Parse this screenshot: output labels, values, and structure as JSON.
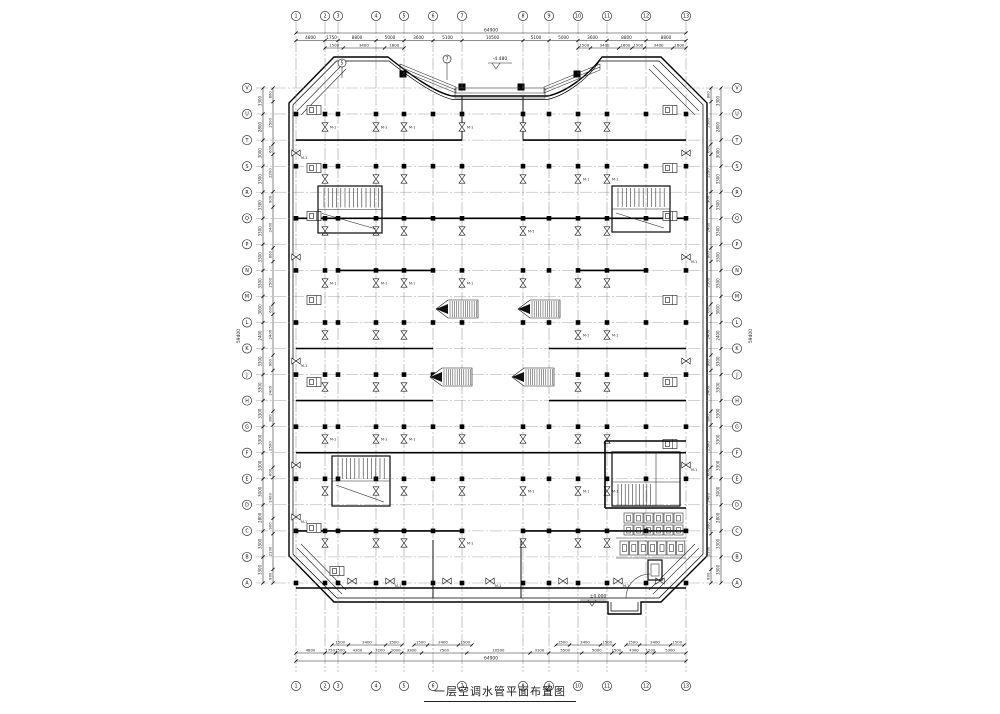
{
  "drawing": {
    "title": "一层空调水管平面布置图"
  },
  "axes": {
    "top": [
      "1",
      "2",
      "3",
      "4",
      "5",
      "6",
      "7",
      "8",
      "9",
      "10",
      "11",
      "12",
      "13"
    ],
    "bottom": [
      "1",
      "2",
      "3",
      "4",
      "5",
      "6",
      "7",
      "8",
      "9",
      "10",
      "11",
      "12",
      "13"
    ],
    "left": [
      "V",
      "U",
      "T",
      "S",
      "R",
      "Q",
      "P",
      "N",
      "M",
      "L",
      "K",
      "J",
      "H",
      "G",
      "F",
      "E",
      "D",
      "C",
      "B",
      "A"
    ],
    "right": [
      "V",
      "U",
      "T",
      "S",
      "R",
      "Q",
      "P",
      "N",
      "M",
      "L",
      "K",
      "J",
      "H",
      "G",
      "F",
      "E",
      "D",
      "C",
      "B",
      "A"
    ]
  },
  "dimensions": {
    "top_total": "64900",
    "top_major": [
      "4800",
      "1750",
      "8800",
      "5000",
      "3600",
      "5100",
      "10500",
      "5100",
      "5000",
      "3600",
      "8800",
      "8800"
    ],
    "top_sub_left": [
      "1500",
      "3400",
      "1600"
    ],
    "top_sub_right": [
      "1500",
      "3400",
      "1600",
      "1500",
      "3400",
      "1600"
    ],
    "bottom_total": "64900",
    "bottom_major": [
      "4800",
      "1750",
      "1500",
      "4300",
      "3200",
      "2000",
      "3300",
      "7500",
      "10500",
      "3100",
      "5500",
      "5000",
      "1500",
      "4300",
      "1200",
      "5300"
    ],
    "bottom_sub": [
      "1500",
      "3400",
      "1500"
    ],
    "left_total": "59400",
    "left_major": [
      "3300",
      "2800",
      "3000",
      "3300",
      "3300",
      "3300",
      "3300",
      "3300",
      "3000",
      "2400",
      "3300",
      "3300",
      "3300",
      "3300",
      "3300",
      "3000",
      "2800",
      "3300",
      "3300"
    ],
    "left_sub": [
      "800",
      "2500",
      "600",
      "2200",
      "900",
      "2400",
      "800",
      "2500",
      "600",
      "2400",
      "900",
      "2400",
      "800",
      "2500",
      "600",
      "2400",
      "900",
      "2100",
      "800"
    ],
    "right_total": "59400",
    "right_major": [
      "3300",
      "2800",
      "3000",
      "3300",
      "3300",
      "3300",
      "3300",
      "3300",
      "3000",
      "2400",
      "3300",
      "3300",
      "3300",
      "3300",
      "3300",
      "3000",
      "2800",
      "3300",
      "3300"
    ],
    "right_sub": [
      "800",
      "2500",
      "600",
      "2200",
      "900",
      "2400",
      "800",
      "2500",
      "600",
      "2400",
      "900",
      "2400",
      "800",
      "2500",
      "600",
      "2400",
      "900",
      "2100",
      "800"
    ]
  },
  "annotations": {
    "entrance_level": "-4.480",
    "ground_level": "±0.000",
    "fcu_label": "M-1",
    "detail_mark_left": "5",
    "detail_mark_right": "7"
  }
}
